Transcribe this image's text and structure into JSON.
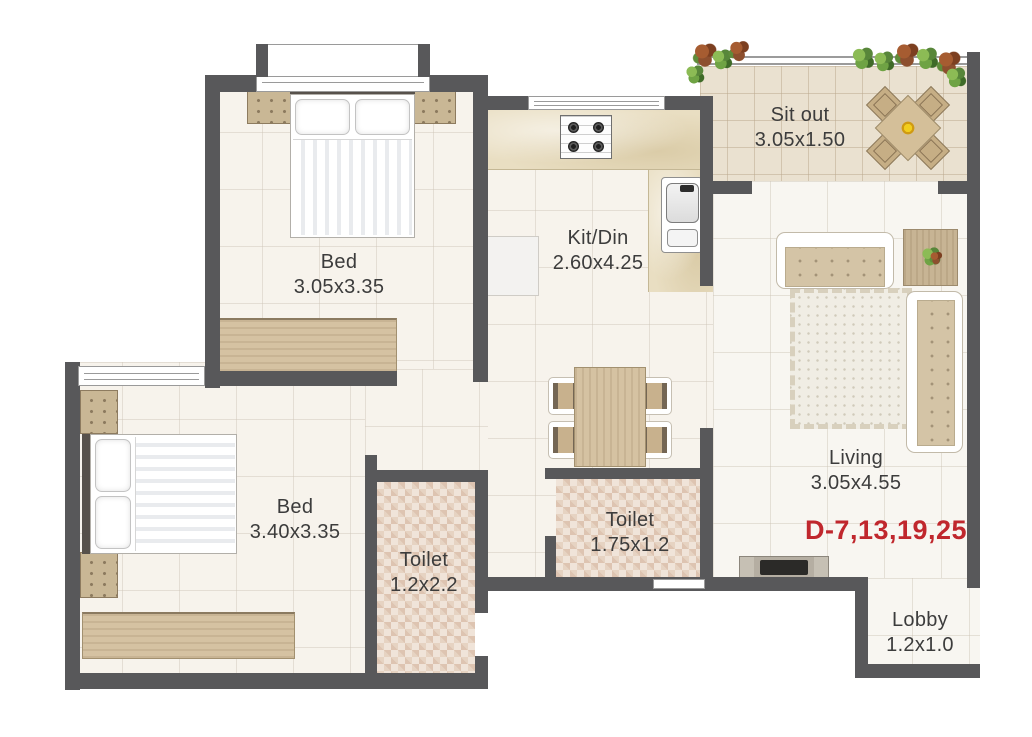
{
  "plan": {
    "unit_label": "D-7,13,19,25",
    "rooms": {
      "bedroom1": {
        "name": "Bed",
        "dims": "3.05x3.35"
      },
      "bedroom2": {
        "name": "Bed",
        "dims": "3.40x3.35"
      },
      "kitchen_dining": {
        "name": "Kit/Din",
        "dims": "2.60x4.25"
      },
      "sit_out": {
        "name": "Sit out",
        "dims": "3.05x1.50"
      },
      "living": {
        "name": "Living",
        "dims": "3.05x4.55"
      },
      "toilet1": {
        "name": "Toilet",
        "dims": "1.2x2.2"
      },
      "toilet2": {
        "name": "Toilet",
        "dims": "1.75x1.2"
      },
      "lobby": {
        "name": "Lobby",
        "dims": "1.2x1.0"
      }
    },
    "colors": {
      "wall": "#58585a",
      "unit_label_text": "#c0272d",
      "label_text": "#3c3c3c"
    }
  }
}
